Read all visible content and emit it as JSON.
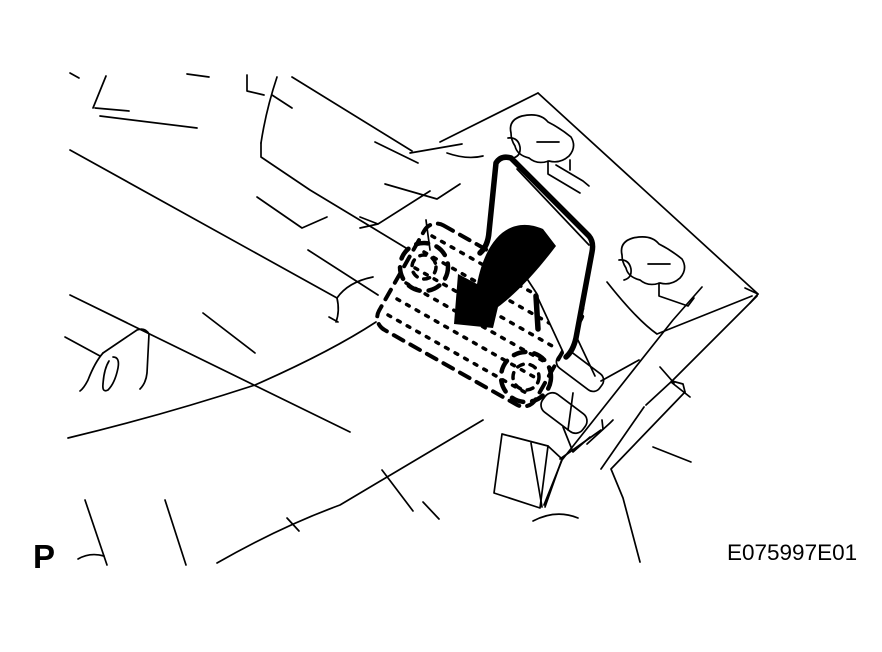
{
  "figure": {
    "page_marker": "P",
    "figure_id": "E075997E01"
  },
  "colors": {
    "background": "#ffffff",
    "line": "#000000",
    "arrow_fill": "#000000"
  },
  "diagram": {
    "type": "line-art",
    "style": "black-and-white service-manual illustration",
    "parts": [
      "instrument-panel-structure",
      "instrument-panel-beam",
      "kick-panel",
      "bracket-tab-with-hole",
      "mounting-bracket-panel",
      "panel-clip-upper",
      "panel-clip-lower",
      "ecu-cover",
      "hidden-unit-dashed-outline",
      "fastener-circle-1",
      "fastener-circle-2",
      "lower-bracket-tabs",
      "floor-bracket",
      "diagonal-brace",
      "rotation-arrow"
    ],
    "rotation_arrow_direction": "down-left",
    "fastener_circle_count": 2
  }
}
